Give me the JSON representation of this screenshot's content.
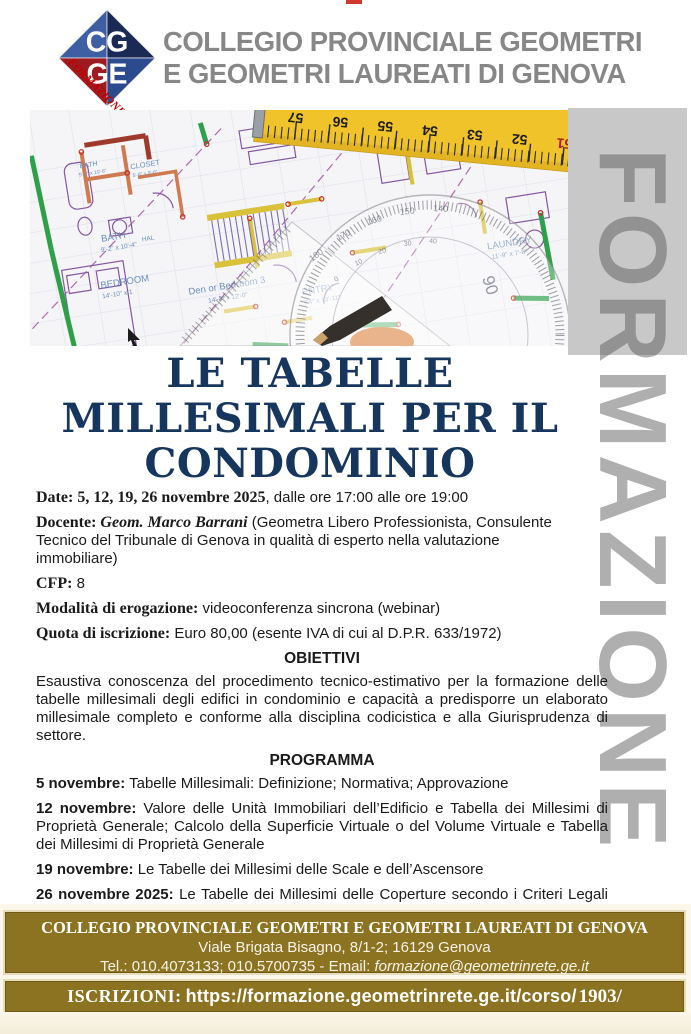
{
  "header": {
    "logo": {
      "top": "CG",
      "bottom": "GE",
      "ribbon": "FORMAZIONE"
    },
    "title_line1": "COLLEGIO PROVINCIALE GEOMETRI",
    "title_line2": "E GEOMETRI LAUREATI DI GENOVA"
  },
  "watermark": "FORMAZIONE",
  "photo": {
    "rooms": {
      "bath_small": "BATH",
      "bath_small_dim": "5'-2\" x 10'-6\"",
      "closet": "CLOSET",
      "closet_dim": "5'-8\" x 9'-6\"",
      "bath": "BATH",
      "bath_dim": "9'-2\" x 10'-4\"",
      "hall": "HAL",
      "bedroom": "BEDROOM",
      "bedroom_dim": "14'-10\" x 1",
      "den": "Den or Bedroom 3",
      "den_dim": "14'-3\" x 12'-0\"",
      "entry": "ENTRY",
      "entry_dim": "7'4\" x 13'-11\"",
      "laundry": "LAUNDRY",
      "laundry_dim": "11'-9\" x 7'-8\""
    },
    "tape_numbers": [
      "57",
      "56",
      "55",
      "54",
      "53",
      "52",
      "51"
    ],
    "protractor_numbers": [
      "180",
      "170",
      "160",
      "150",
      "140"
    ],
    "protractor_inner": [
      "0",
      "10",
      "20",
      "30",
      "40"
    ],
    "protractor_90": "90"
  },
  "title": {
    "line1": "LE TABELLE",
    "line2": "MILLESIMALI PER IL",
    "line3": "CONDOMINIO"
  },
  "details": {
    "date_label": "Date:",
    "date_value_bold": " 5, 12, 19, 26 novembre 2025",
    "date_value_rest": ", dalle ore 17:00 alle ore 19:00",
    "docente_label": "Docente:",
    "docente_name": " Geom. Marco Barrani",
    "docente_rest": " (Geometra Libero Professionista, Consulente Tecnico del Tribunale di Genova in qualità di esperto nella valutazione immobiliare)",
    "cfp_label": "CFP:",
    "cfp_value": " 8",
    "modalita_label": "Modalità di erogazione:",
    "modalita_value": " videoconferenza sincrona (webinar)",
    "quota_label": "Quota di iscrizione:",
    "quota_value": " Euro 80,00 (esente IVA di cui al D.P.R. 633/1972)"
  },
  "obiettivi": {
    "heading": "OBIETTIVI",
    "text": "Esaustiva conoscenza del procedimento tecnico-estimativo per la formazione delle tabelle millesimali degli edifici in condominio e capacità a predisporre un elaborato millesimale completo e conforme alla disciplina codicistica e alla Giurisprudenza di settore."
  },
  "programma": {
    "heading": "PROGRAMMA",
    "items": [
      {
        "lead": "5 novembre:",
        "text": " Tabelle Millesimali: Definizione; Normativa; Approvazione"
      },
      {
        "lead": "12 novembre:",
        "text": " Valore delle Unità Immobiliari dell’Edificio e Tabella dei Millesimi di Proprietà Generale; Calcolo della Superficie Virtuale o del Volume Virtuale e Tabella dei Millesimi di Proprietà Generale"
      },
      {
        "lead": "19 novembre:",
        "text": " Le Tabelle dei Millesimi delle Scale e dell’Ascensore"
      },
      {
        "lead": "26 novembre 2025:",
        "text": " Le Tabelle dei Millesimi delle Coperture secondo i Criteri Legali di Ripartizione; Caso Studio"
      }
    ]
  },
  "footer": {
    "line1": "COLLEGIO PROVINCIALE GEOMETRI E GEOMETRI LAUREATI DI GENOVA",
    "address": "Viale Brigata Bisagno, 8/1-2; 16129 Genova",
    "tel_prefix": "Tel.: 010.4073133; 010.5700735 - Email: ",
    "email": "formazione@geometrinrete.ge.it",
    "iscrizioni_label": "ISCRIZIONI:",
    "url": "https://formazione.geometrinrete.ge.it/corso/",
    "code": "1903/"
  },
  "colors": {
    "navy_title": "#17365d",
    "header_gray": "#878787",
    "footer_gold": "#8c7322",
    "watermark_gray": "#a9a9a9",
    "logo_blue_nw": "#3f5fa5",
    "logo_navy_ne": "#1b2a55",
    "logo_red_sw": "#9e1b20",
    "logo_blue_se": "#2c4a8e",
    "ribbon_red": "#c00000"
  }
}
